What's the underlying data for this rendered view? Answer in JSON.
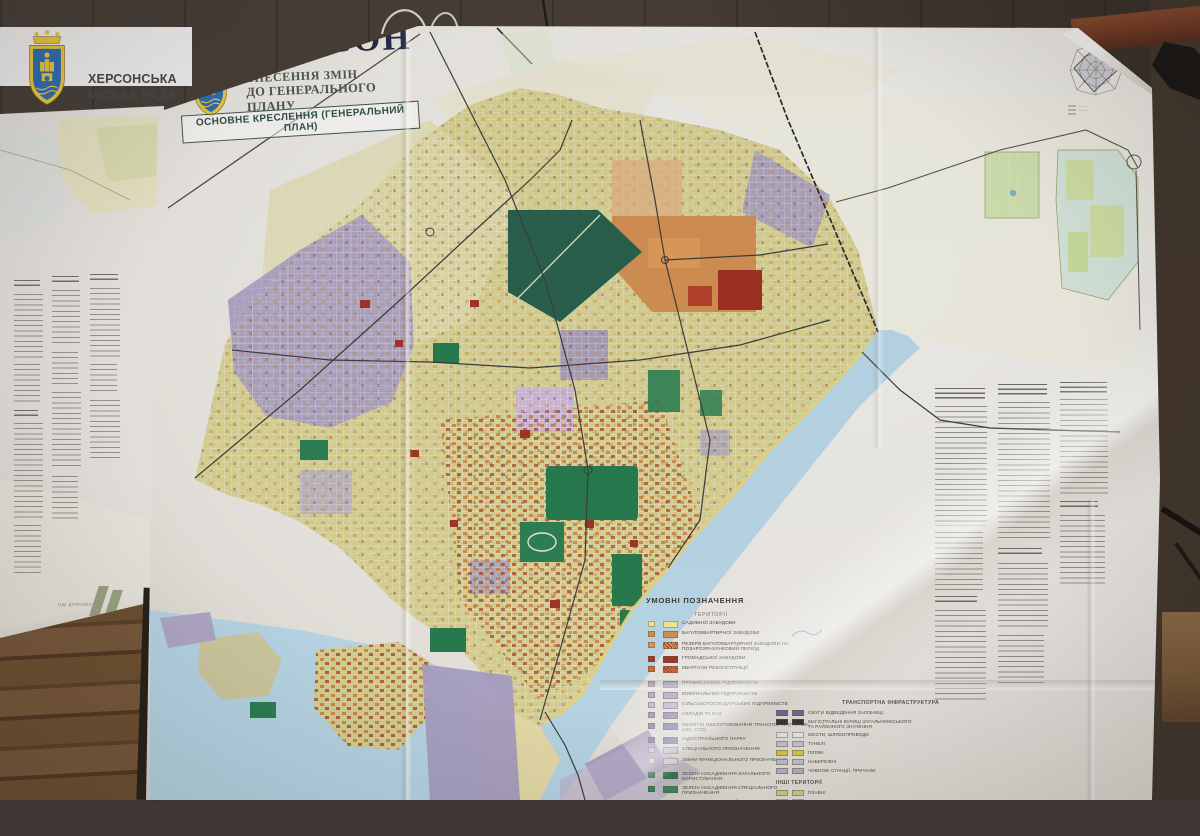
{
  "banner": {
    "org_line1": "ХЕРСОНСЬКА",
    "org_line2": "МІСЬКА РАДА"
  },
  "title_block": {
    "city": "ХЕРСОН",
    "subtitle_line1": "ВНЕСЕННЯ ЗМІН",
    "subtitle_line2": "ДО ГЕНЕРАЛЬНОГО ПЛАНУ",
    "drawing_label": "ОСНОВНЕ КРЕСЛЕННЯ (ГЕНЕРАЛЬНИЙ ПЛАН)"
  },
  "left_sheet": {
    "logo_text": "НДІ ДІПРОМІСТО"
  },
  "wind_rose": {
    "caption": "РОЗА ВІТРІВ"
  },
  "legend": {
    "header": "УМОВНІ ПОЗНАЧЕННЯ",
    "territories_header": "ТЕРИТОРІЇ",
    "territory_items": [
      {
        "label": "САДИБНОЇ ЗАБУДОВИ",
        "color": "#efe98f"
      },
      {
        "label": "БАГАТОКВАРТИРНОЇ ЗАБУДОВИ",
        "color": "#d2914e"
      },
      {
        "label": "РЕЗЕРВ БАГАТОКВАРТИРНОЇ ЗАБУДОВИ НА ПОЗАРОЗРАХУНКОВИЙ ПЕРІОД",
        "color": "#d89b55"
      },
      {
        "label": "ГРОМАДСЬКОЇ ЗАБУДОВИ",
        "color": "#a2362a"
      },
      {
        "label": "КВАРТАЛИ РЕКОНСТРУКЦІЇ",
        "color": "#cf6a3a"
      }
    ],
    "zone_items": [
      {
        "label": "ПРОМИСЛОВИХ ПІДПРИЄМСТВ",
        "color": "#a79ec1"
      },
      {
        "label": "КОМУНАЛЬНИХ ПІДПРИЄМСТВ",
        "color": "#b3abc9"
      },
      {
        "label": "СІЛЬСЬКОГОСПОДАРСЬКИХ ПІДПРИЄМСТВ",
        "color": "#c0b9d2"
      },
      {
        "label": "СКЛАДІВ ТА БАЗ",
        "color": "#978dbb"
      },
      {
        "label": "ОБ'ЄКТІВ ОБСЛУГОВУВАННЯ ТРАНСПОРТУ (ГАРАЖІ, АЗС, СТО)",
        "color": "#877cab"
      },
      {
        "label": "ІНДУСТРІАЛЬНОГО ПАРКУ",
        "color": "#7b6fa3"
      },
      {
        "label": "СПЕЦІАЛЬНОГО ПРИЗНАЧЕННЯ",
        "color": "#cdc7dc"
      },
      {
        "label": "ЗМІНИ ФУНКЦІОНАЛЬНОГО ПРИЗНАЧЕННЯ",
        "color": "#ded9e8"
      }
    ],
    "green_items": [
      {
        "label": "ЗЕЛЕНІ НАСАДЖЕННЯ ЗАГАЛЬНОГО КОРИСТУВАННЯ",
        "color": "#1f7b50"
      },
      {
        "label": "ЗЕЛЕНІ НАСАДЖЕННЯ СПЕЦІАЛЬНОГО ПРИЗНАЧЕННЯ",
        "color": "#2e8a5c"
      },
      {
        "label": "ОЗЕЛЕНЕНІ ТЕРИТОРІЇ В МЕЖАХ САНІТАРНО-ЗАХИСНИХ ЗОН",
        "color": "#8cc7a6"
      },
      {
        "label": "ЛІСОПАРКИ",
        "color": "#bfe0cd"
      }
    ],
    "transport_header": "ТРАНСПОРТНА ІНФРАСТРУКТУРА",
    "transport_items": [
      {
        "label": "СМУГИ ВІДВЕДЕННЯ ЗАЛІЗНИЦІ",
        "color": "#6f6398"
      },
      {
        "label": "МАГІСТРАЛЬНІ ВУЛИЦІ ЗАГАЛЬНОМІСЬКОГО ТА РАЙОННОГО ЗНАЧЕННЯ",
        "color": "#2e2e2e"
      },
      {
        "label": "МОСТИ, ШЛЯХОПРОВОДИ",
        "color": "#ececf2"
      },
      {
        "label": "ТУНЕЛІ",
        "color": "#c6c6d4"
      },
      {
        "label": "ПЛЯЖІ",
        "color": "#d9c94a"
      },
      {
        "label": "НАБЕРЕЖНІ",
        "color": "#c0c0d0"
      },
      {
        "label": "ЧОВНОВІ СТАНЦІЇ, ПРИЧАЛИ",
        "color": "#b2b2c6"
      }
    ],
    "other_header": "ІНШІ ТЕРИТОРІЇ",
    "other_items": [
      {
        "label": "ПЛАВНІ",
        "color": "#c9cd86"
      },
      {
        "label": "ЛУЧНА РОСЛИННІСТЬ",
        "color": "#dfe3c2"
      }
    ]
  },
  "map_colors": {
    "residential": "#d6d093",
    "industrial": "#a79ec1",
    "public": "#a2362a",
    "multiapartment": "#d0894c",
    "green": "#277a4e",
    "water": "#b7d6e6",
    "beach": "#e6d57a",
    "paper": "#ece9e3"
  }
}
